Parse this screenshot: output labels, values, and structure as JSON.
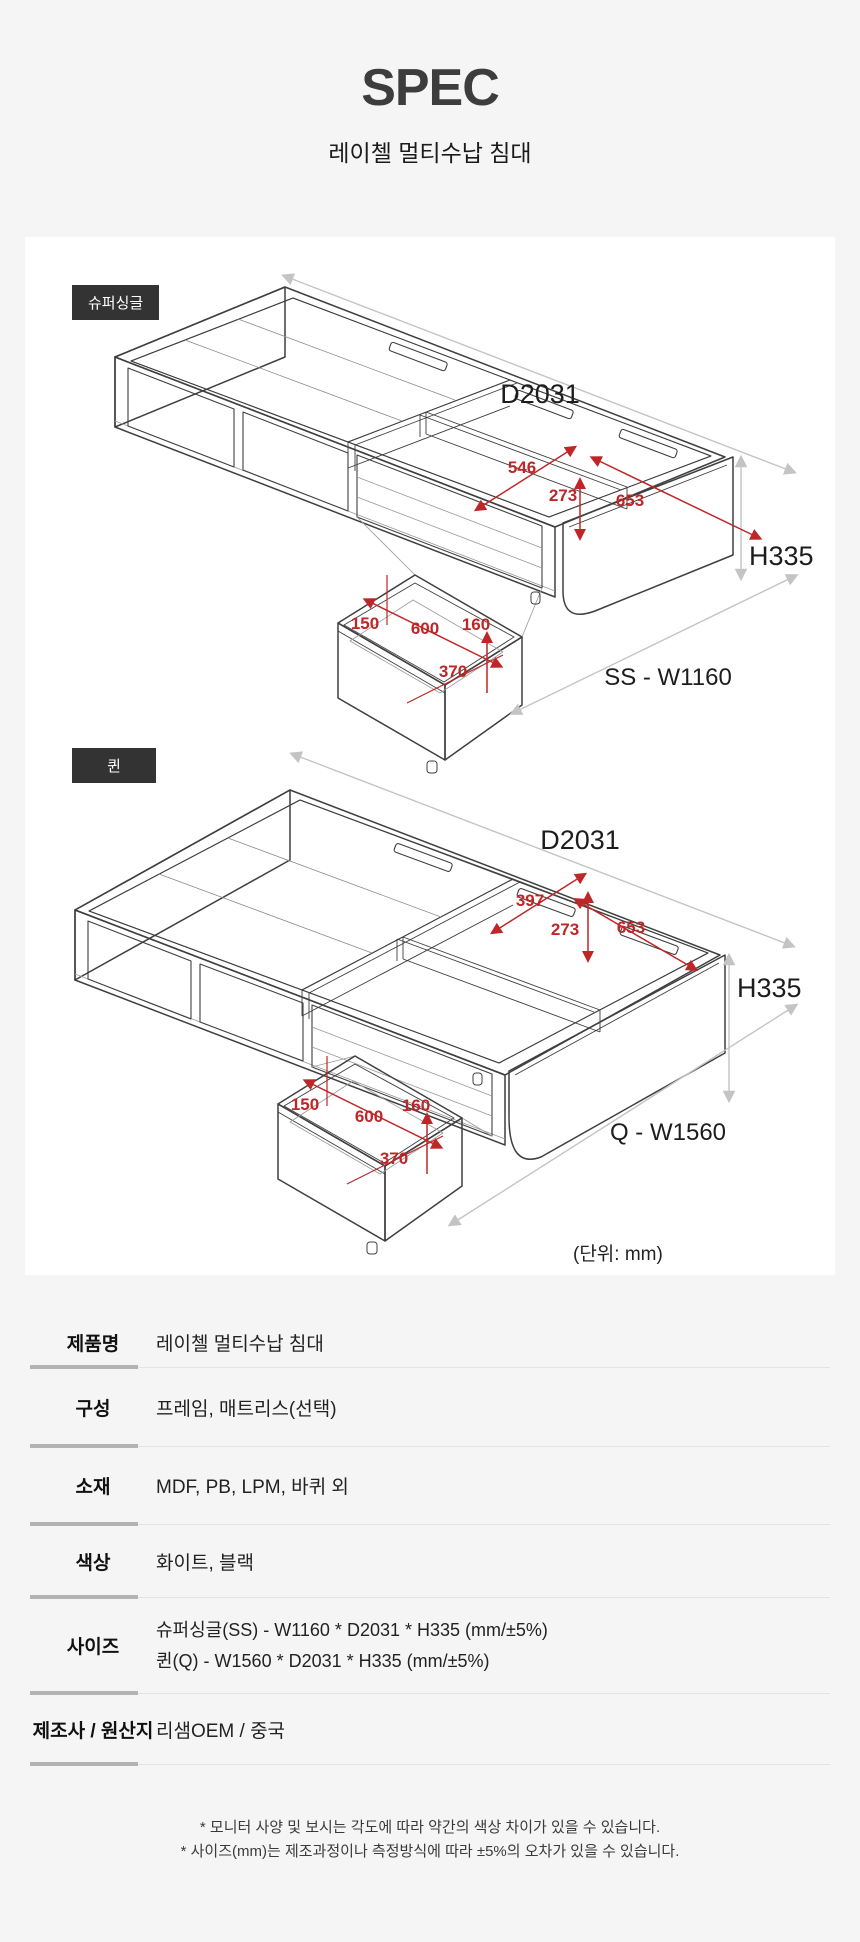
{
  "page": {
    "title": "SPEC",
    "subtitle": "레이첼 멀티수납 침대",
    "background": "#f5f5f6",
    "accent_red": "#bf2628"
  },
  "diagram": {
    "unit_note": "(단위: mm)",
    "super_single": {
      "badge": "슈퍼싱글",
      "labels": {
        "depth": "D2031",
        "height": "H335",
        "width": "SS - W1160",
        "comp_a": "546",
        "comp_b": "273",
        "comp_c": "653",
        "drawer_a": "150",
        "drawer_b": "600",
        "drawer_c": "160",
        "drawer_d": "370"
      }
    },
    "queen": {
      "badge": "퀸",
      "labels": {
        "depth": "D2031",
        "height": "H335",
        "width": "Q - W1560",
        "comp_a": "397",
        "comp_b": "273",
        "comp_c": "653",
        "drawer_a": "150",
        "drawer_b": "600",
        "drawer_c": "160",
        "drawer_d": "370"
      }
    }
  },
  "spec_table": {
    "rows": [
      {
        "label": "제품명",
        "value": "레이첼 멀티수납 침대"
      },
      {
        "label": "구성",
        "value": "프레임, 매트리스(선택)"
      },
      {
        "label": "소재",
        "value": "MDF, PB, LPM, 바퀴 외"
      },
      {
        "label": "색상",
        "value": "화이트, 블랙"
      },
      {
        "label": "사이즈",
        "lines": [
          "슈퍼싱글(SS) - W1160 * D2031 * H335 (mm/±5%)",
          "퀸(Q) - W1560 * D2031 * H335 (mm/±5%)"
        ]
      },
      {
        "label": "제조사 / 원산지",
        "value": "리샘OEM / 중국"
      }
    ]
  },
  "footnotes": [
    "* 모니터 사양 및 보시는 각도에 따라 약간의 색상 차이가 있을 수 있습니다.",
    "* 사이즈(mm)는 제조과정이나 측정방식에 따라 ±5%의 오차가 있을 수 있습니다."
  ]
}
